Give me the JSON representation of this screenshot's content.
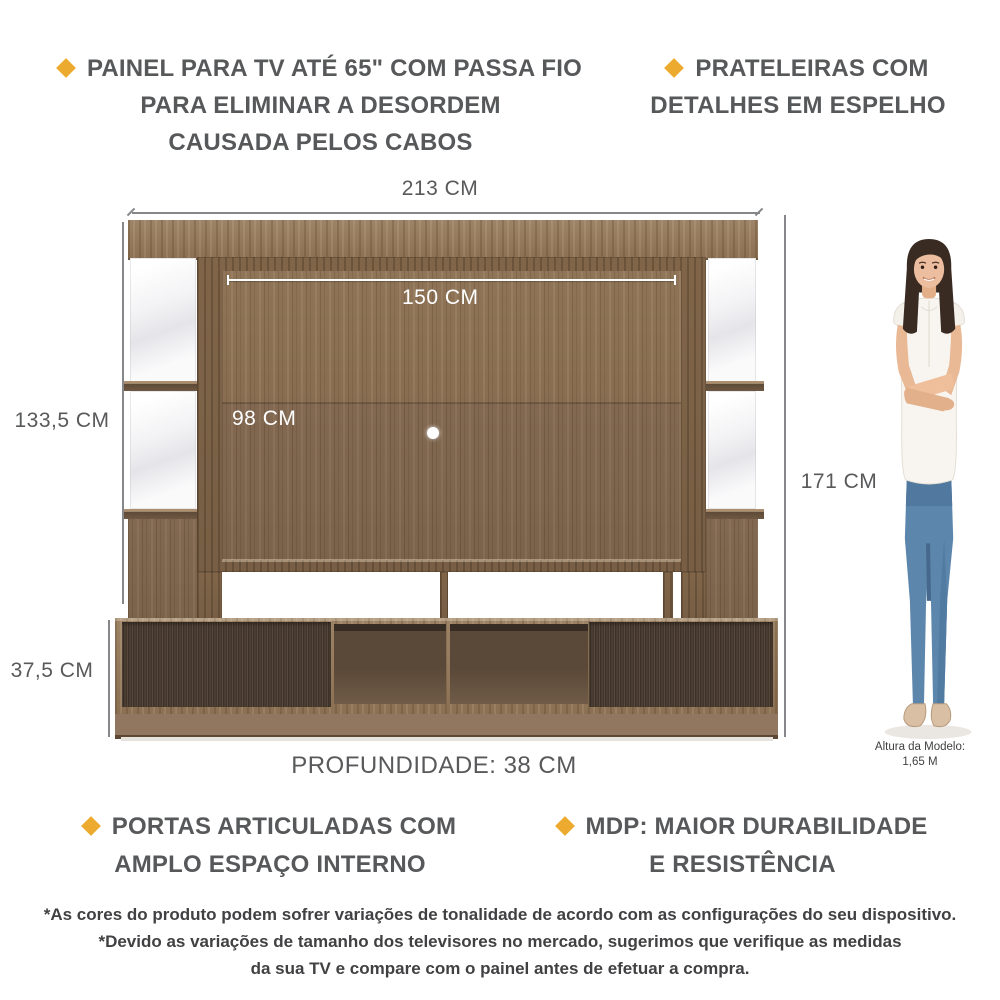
{
  "colors": {
    "accent_diamond": "#ECAB2F",
    "text_dark": "#57585A",
    "dimension_line": "#85878A",
    "wood_medium": "#8C7053",
    "wood_door_dark": "#42362C"
  },
  "features": {
    "top_left": {
      "line1": "PAINEL PARA TV ATÉ 65\" COM PASSA FIO",
      "line2": "PARA ELIMINAR A DESORDEM",
      "line3": "CAUSADA PELOS CABOS"
    },
    "top_right": {
      "line1": "PRATELEIRAS COM",
      "line2": "DETALHES EM ESPELHO"
    },
    "bottom_left": {
      "line1": "PORTAS ARTICULADAS COM",
      "line2": "AMPLO ESPAÇO INTERNO"
    },
    "bottom_right": {
      "line1": "MDP: MAIOR DURABILIDADE",
      "line2": "E RESISTÊNCIA"
    }
  },
  "dimensions": {
    "total_width": "213 CM",
    "panel_width": "150 CM",
    "side_height": "133,5 CM",
    "panel_height": "98 CM",
    "total_height": "171 CM",
    "base_height": "37,5 CM",
    "depth": "PROFUNDIDADE: 38 CM"
  },
  "model": {
    "caption_line1": "Altura da Modelo:",
    "caption_line2": "1,65 M"
  },
  "disclaimer": {
    "line1": "*As cores do produto podem sofrer variações de tonalidade de acordo com as configurações do seu dispositivo.",
    "line2": "*Devido as variações de tamanho dos televisores no mercado, sugerimos que verifique as medidas",
    "line3": "da sua TV e compare com o painel antes de efetuar a compra."
  }
}
